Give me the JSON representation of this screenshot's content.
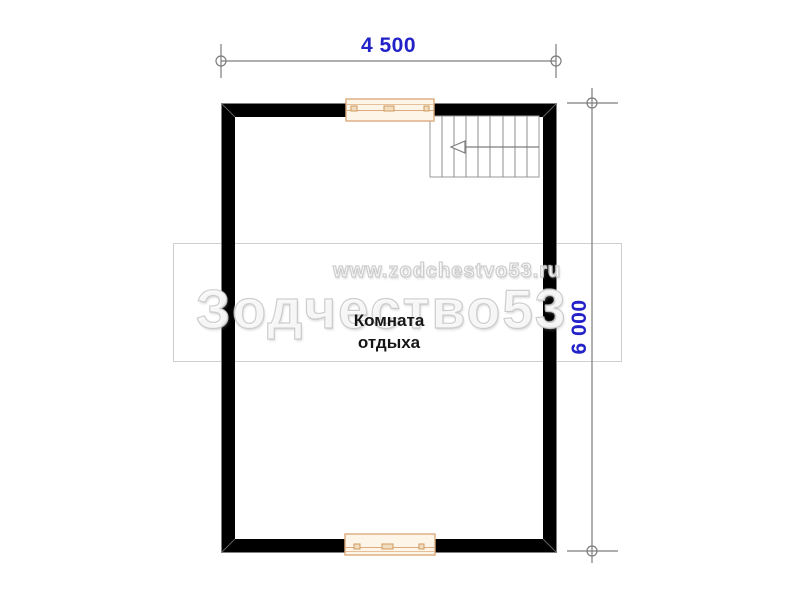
{
  "room": {
    "name_line1": "Комната",
    "name_line2": "отдыха"
  },
  "dimensions": {
    "width": "4 500",
    "height": "6 000"
  },
  "watermark": {
    "url": "www.zodchestvo53.ru",
    "brand": "Зодчество53"
  },
  "icons": {
    "stair_direction": "left-arrow"
  },
  "colors": {
    "dimension_text": "#2222c8",
    "wall": "#000000",
    "drawing_lines": "#7d7d7d",
    "window_frame": "#ddab7e",
    "window_fill": "#fdf5e8",
    "watermark_gray": "#cfcfcf"
  }
}
